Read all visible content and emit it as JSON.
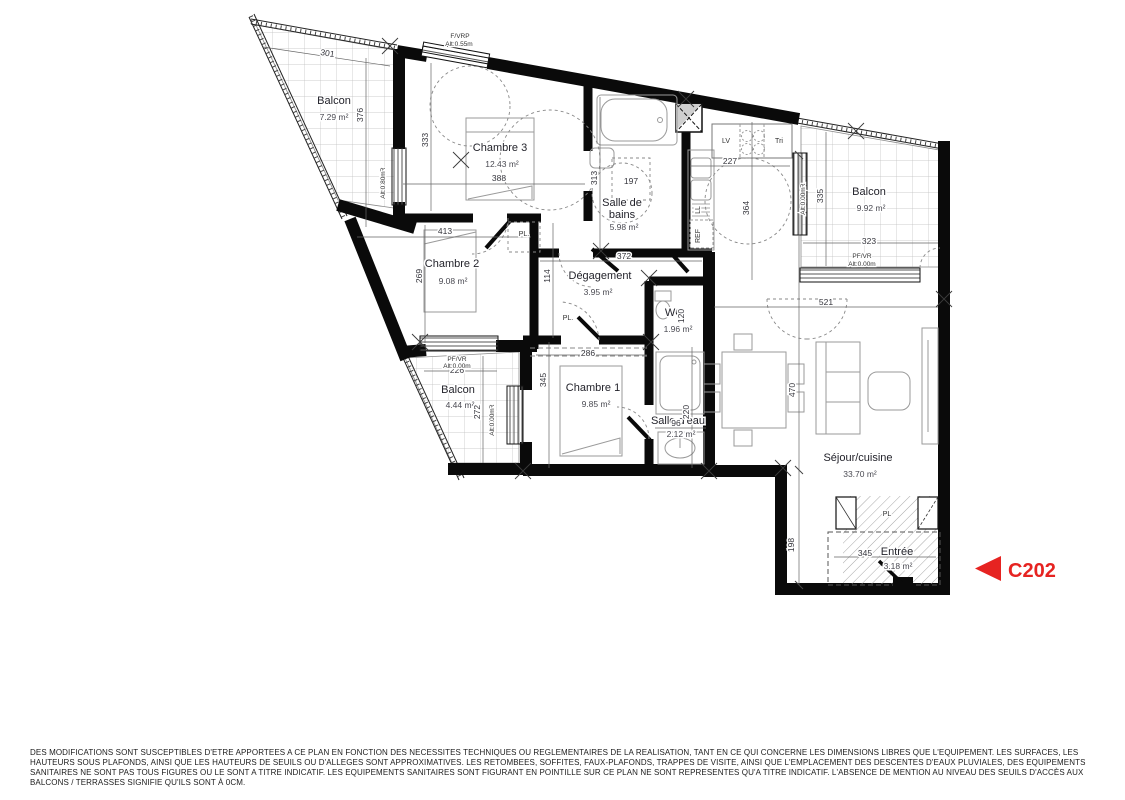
{
  "colors": {
    "accent": "#e62321",
    "wall": "#0a0a0a"
  },
  "unit": {
    "label": "C202"
  },
  "rooms": {
    "balcon_tl": {
      "name": "Balcon",
      "area": "7.29 m²"
    },
    "chambre3": {
      "name": "Chambre 3",
      "area": "12.43 m²"
    },
    "sdb": {
      "name_l1": "Salle de",
      "name_l2": "bains",
      "area": "5.98 m²"
    },
    "chambre2": {
      "name": "Chambre 2",
      "area": "9.08 m²"
    },
    "degagement": {
      "name": "Dégagement",
      "area": "3.95 m²"
    },
    "wc": {
      "name": "WC",
      "area": "1.96 m²"
    },
    "balcon_r": {
      "name": "Balcon",
      "area": "9.92 m²"
    },
    "balcon_bl": {
      "name": "Balcon",
      "area": "4.44 m²"
    },
    "chambre1": {
      "name": "Chambre 1",
      "area": "9.85 m²"
    },
    "sde": {
      "name": "Salle d'eau",
      "area": "2.12 m²"
    },
    "sejour": {
      "name": "Séjour/cuisine",
      "area": "33.70 m²"
    },
    "entree": {
      "name": "Entrée",
      "area": "3.18 m²"
    }
  },
  "dims": {
    "balcon1_w": "301",
    "balcon1_h": "376",
    "ch3_h": "333",
    "ch3_w": "388",
    "ch2_w": "413",
    "ch2_h": "269",
    "sdb_h": "313",
    "sdb_inner": "197",
    "deg_w": "372",
    "deg_h": "114",
    "kitchen_w": "227",
    "kitchen_h": "364",
    "balcon2_h": "335",
    "balcon2_w": "323",
    "hall_w": "286",
    "wc_h": "120",
    "balcon3_w": "226",
    "balcon3_h": "272",
    "ch1_h": "345",
    "sde_h": "220",
    "sde_w": "96",
    "sejour_w": "521",
    "sejour_h": "470",
    "entree_h": "198",
    "entree_w": "345"
  },
  "openings": {
    "top": {
      "l1": "F/VRP",
      "l2": "Alt:0.55m"
    },
    "chambre3_west": {
      "l1": "PF/VR",
      "l2": "Alt:0.80m"
    },
    "balcon_r_west": {
      "l1": "PF/VR",
      "l2": "Alt:0.00m"
    },
    "balcon_r_south": {
      "l1": "PF/VR",
      "l2": "Alt:0.00m"
    },
    "balcon_bl_north": {
      "l1": "PF/VR",
      "l2": "Alt:0.00m"
    },
    "balcon_bl_east": {
      "l1": "PF/VR",
      "l2": "Alt:0.00m"
    }
  },
  "fixtures": {
    "pl_chambre3": "PL.",
    "pl_degagement": "PL.",
    "pl_entree": "PL",
    "lv": "LV",
    "tri": "Tri",
    "ref": "REF",
    "ll": "LL"
  },
  "footer": {
    "line1": "DES MODIFICATIONS SONT SUSCEPTIBLES D'ETRE APPORTEES A CE PLAN EN FONCTION DES NECESSITES TECHNIQUES OU REGLEMENTAIRES DE LA REALISATION, TANT EN CE QUI CONCERNE LES DIMENSIONS LIBRES QUE L'EQUIPEMENT. LES SURFACES, LES",
    "line2": "HAUTEURS SOUS PLAFONDS, AINSI QUE LES HAUTEURS DE SEUILS OU D'ALLEGES SONT APPROXIMATIVES. LES RETOMBEES, SOFFITES, FAUX-PLAFONDS, TRAPPES DE VISITE, AINSI QUE L'EMPLACEMENT DES DESCENTES D'EAUX PLUVIALES, DES EQUIPEMENTS",
    "line3": "SANITAIRES NE SONT PAS TOUS FIGURES OU LE SONT A TITRE INDICATIF. LES EQUIPEMENTS SANITAIRES SONT FIGURANT EN POINTILLE SUR CE PLAN NE SONT REPRESENTES QU'A TITRE INDICATIF. L'ABSENCE DE MENTION AU NIVEAU DES SEUILS D'ACCÈS AUX",
    "line4": "BALCONS / TERRASSES SIGNIFIE QU'ILS SONT À 0CM."
  }
}
